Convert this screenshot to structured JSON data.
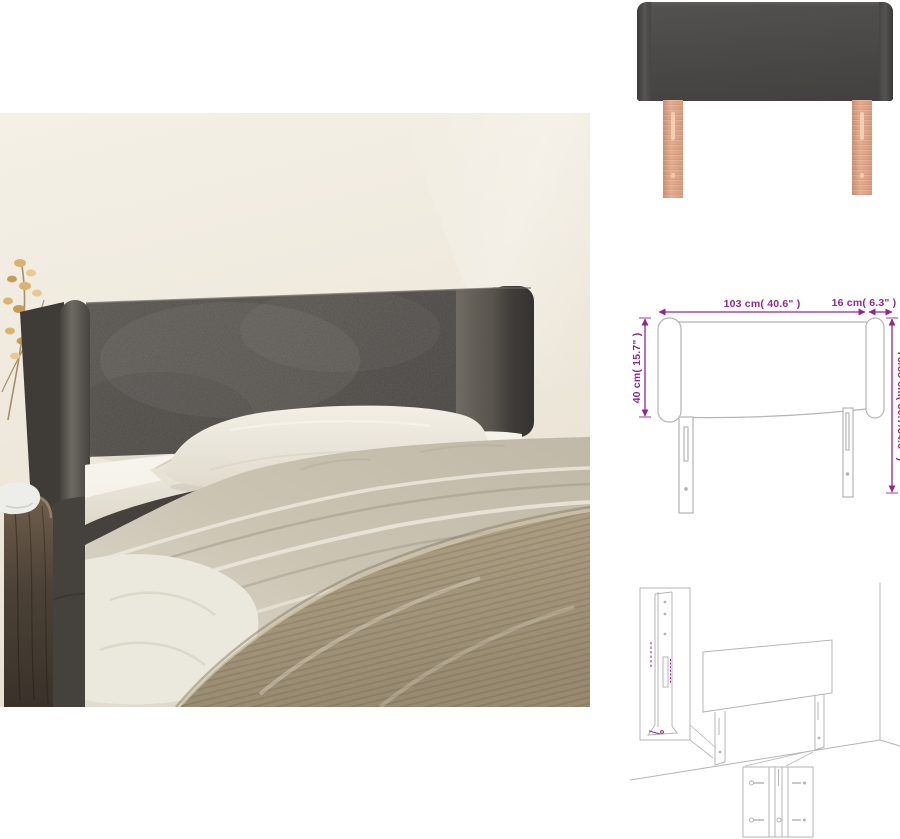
{
  "palette": {
    "page_background": "#ffffff",
    "wall_cream": "#f0eadf",
    "headboard_dark_gray": "#4e4b47",
    "leg_wood_tan": "#dfa78b",
    "bedding_white": "#f0ece2",
    "duvet_beige": "#ccc5b4",
    "blanket_khaki": "#a3957a",
    "nightstand_brown": "#55483c",
    "dimension_accent_magenta": "#93278F",
    "diagram_line_gray": "#b5b5b5"
  },
  "dimension_diagram": {
    "width_label": "103 cm( 40.6\" )",
    "wing_label": "16 cm( 6.3\" )",
    "left_height_label": "40 cm( 15.7\" )",
    "right_height_label": "78/88 cm( 30.7/34.6\" )"
  }
}
